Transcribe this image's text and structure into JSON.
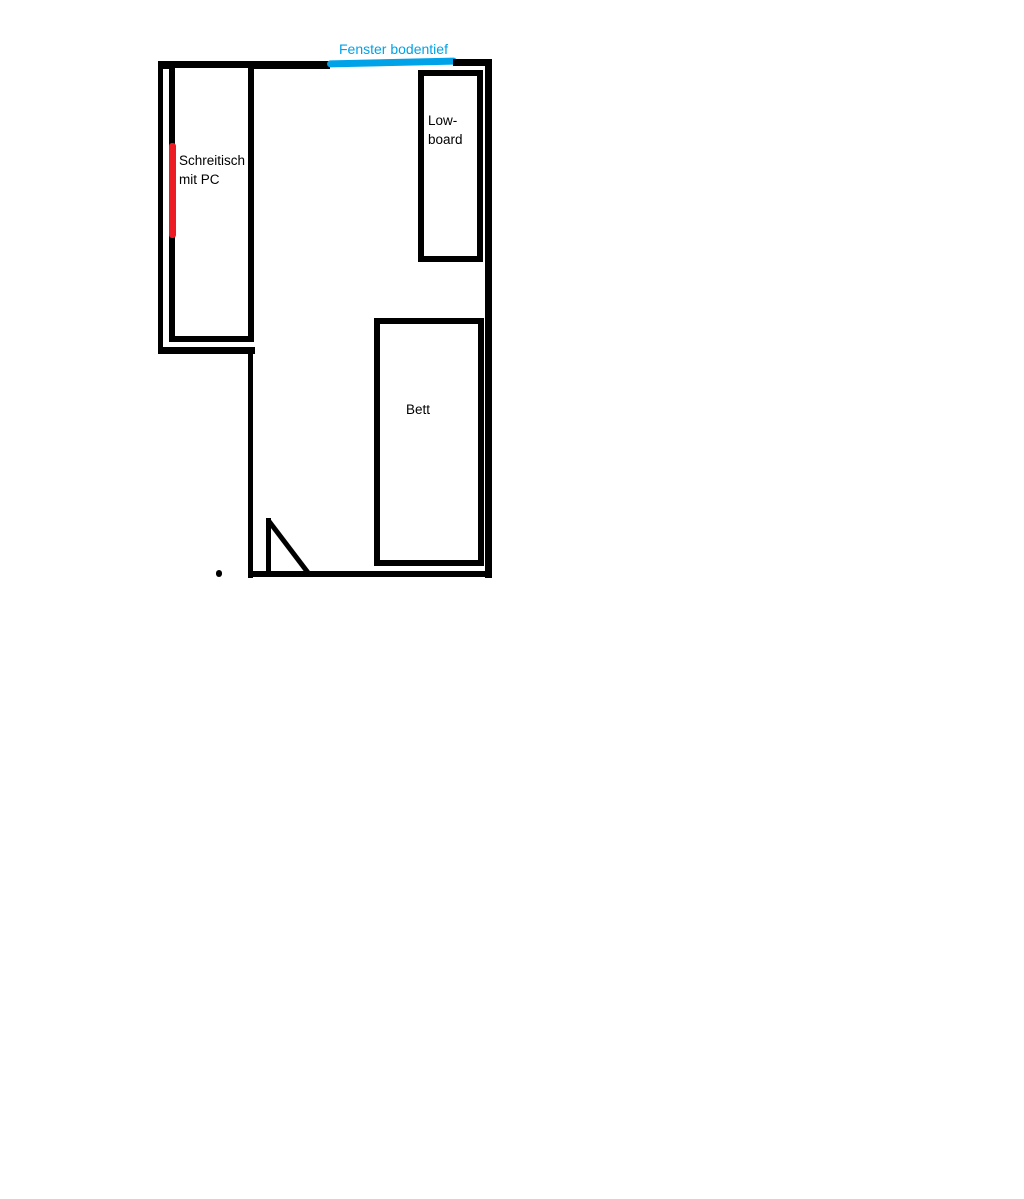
{
  "canvas": {
    "width_px": 1024,
    "height_px": 1199
  },
  "colors": {
    "background": "#ffffff",
    "wall": "#000000",
    "window": "#00a2e8",
    "marker": "#ed1c24",
    "label": "#000000"
  },
  "labels": {
    "window": "Fenster bodentief",
    "desk": {
      "line1": "Schreitisch",
      "line2": "mit PC"
    },
    "lowboard": {
      "line1": "Low-",
      "line2": "board"
    },
    "bed": "Bett"
  }
}
